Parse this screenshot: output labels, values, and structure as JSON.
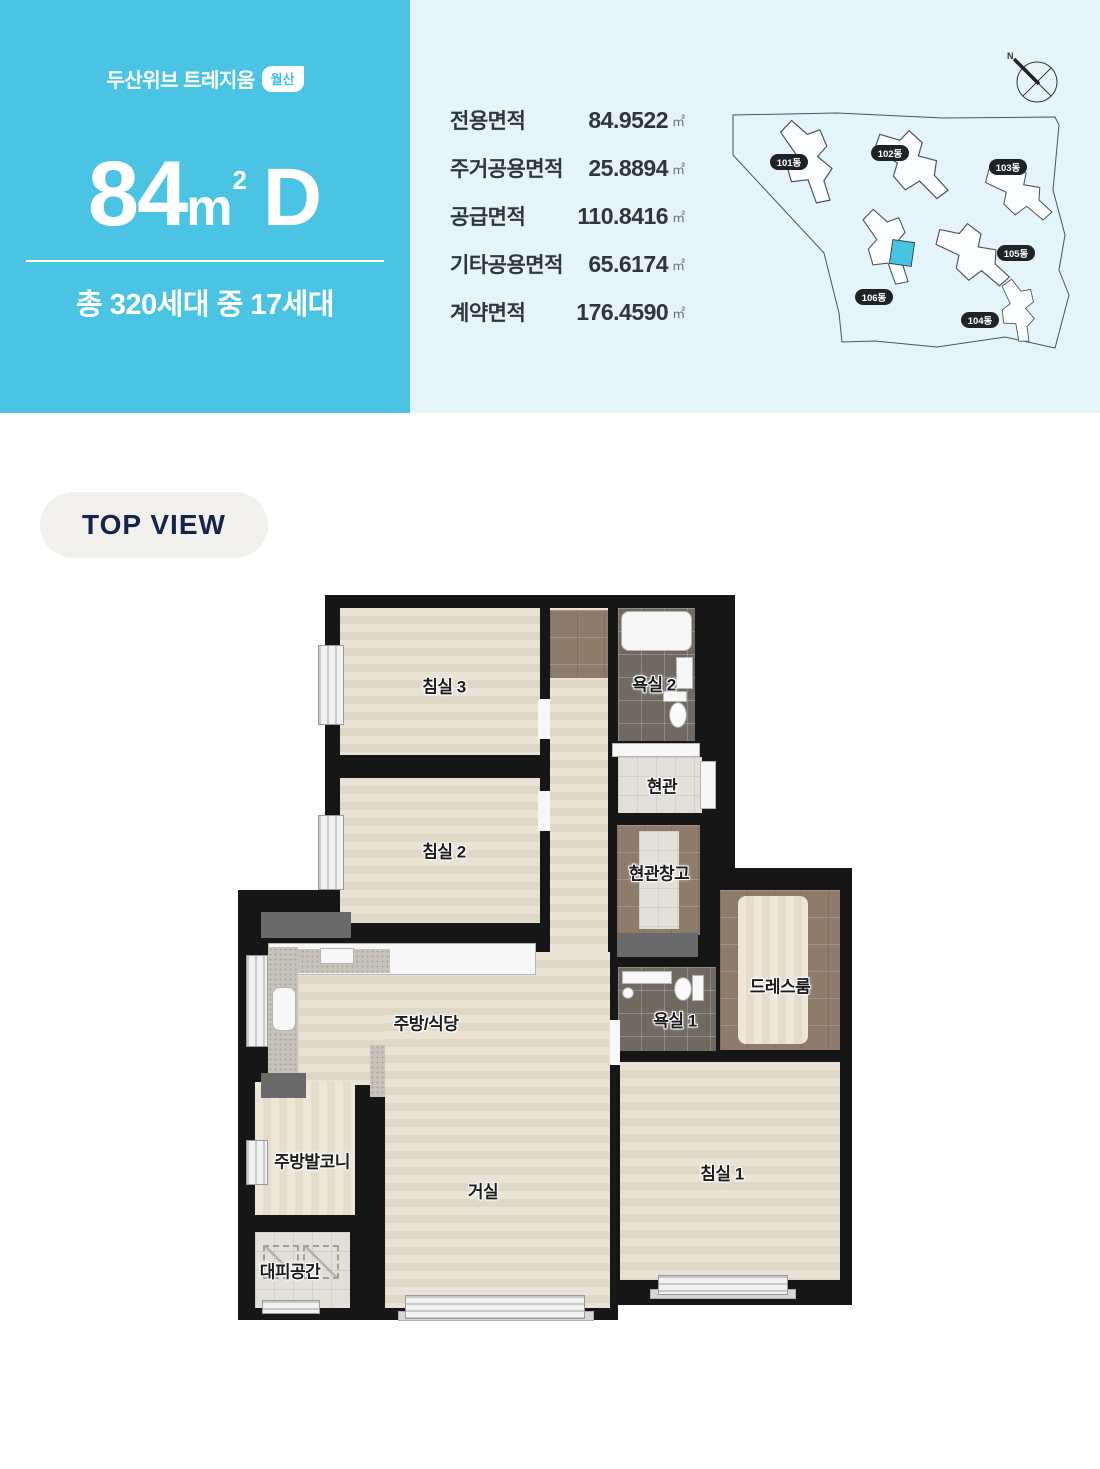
{
  "header": {
    "brand": "두산위브 트레지움",
    "brand_badge": "월산",
    "size_number": "84",
    "size_unit": "m",
    "size_sup": "2",
    "type_letter": "D",
    "household_info": "총 320세대 중 17세대"
  },
  "area_table": {
    "rows": [
      {
        "label": "전용면적",
        "value": "84.9522",
        "unit": "㎡"
      },
      {
        "label": "주거공용면적",
        "value": "25.8894",
        "unit": "㎡"
      },
      {
        "label": "공급면적",
        "value": "110.8416",
        "unit": "㎡"
      },
      {
        "label": "기타공용면적",
        "value": "65.6174",
        "unit": "㎡"
      },
      {
        "label": "계약면적",
        "value": "176.4590",
        "unit": "㎡"
      }
    ]
  },
  "site_plan": {
    "labels": [
      "101동",
      "102동",
      "103동",
      "104동",
      "105동",
      "106동"
    ],
    "compass": "N",
    "highlight_color": "#45c3e0"
  },
  "section_badge": "TOP VIEW",
  "floor_plan": {
    "rooms": [
      {
        "label": "침실 3"
      },
      {
        "label": "욕실 2"
      },
      {
        "label": "현관"
      },
      {
        "label": "침실 2"
      },
      {
        "label": "현관창고"
      },
      {
        "label": "드레스룸"
      },
      {
        "label": "욕실 1"
      },
      {
        "label": "주방/식당"
      },
      {
        "label": "주방발코니"
      },
      {
        "label": "거실"
      },
      {
        "label": "대피공간"
      },
      {
        "label": "침실 1"
      }
    ]
  },
  "colors": {
    "primary": "#4bc4e3",
    "panel": "#e5f4fb",
    "badge_bg": "#f1f0ec"
  }
}
